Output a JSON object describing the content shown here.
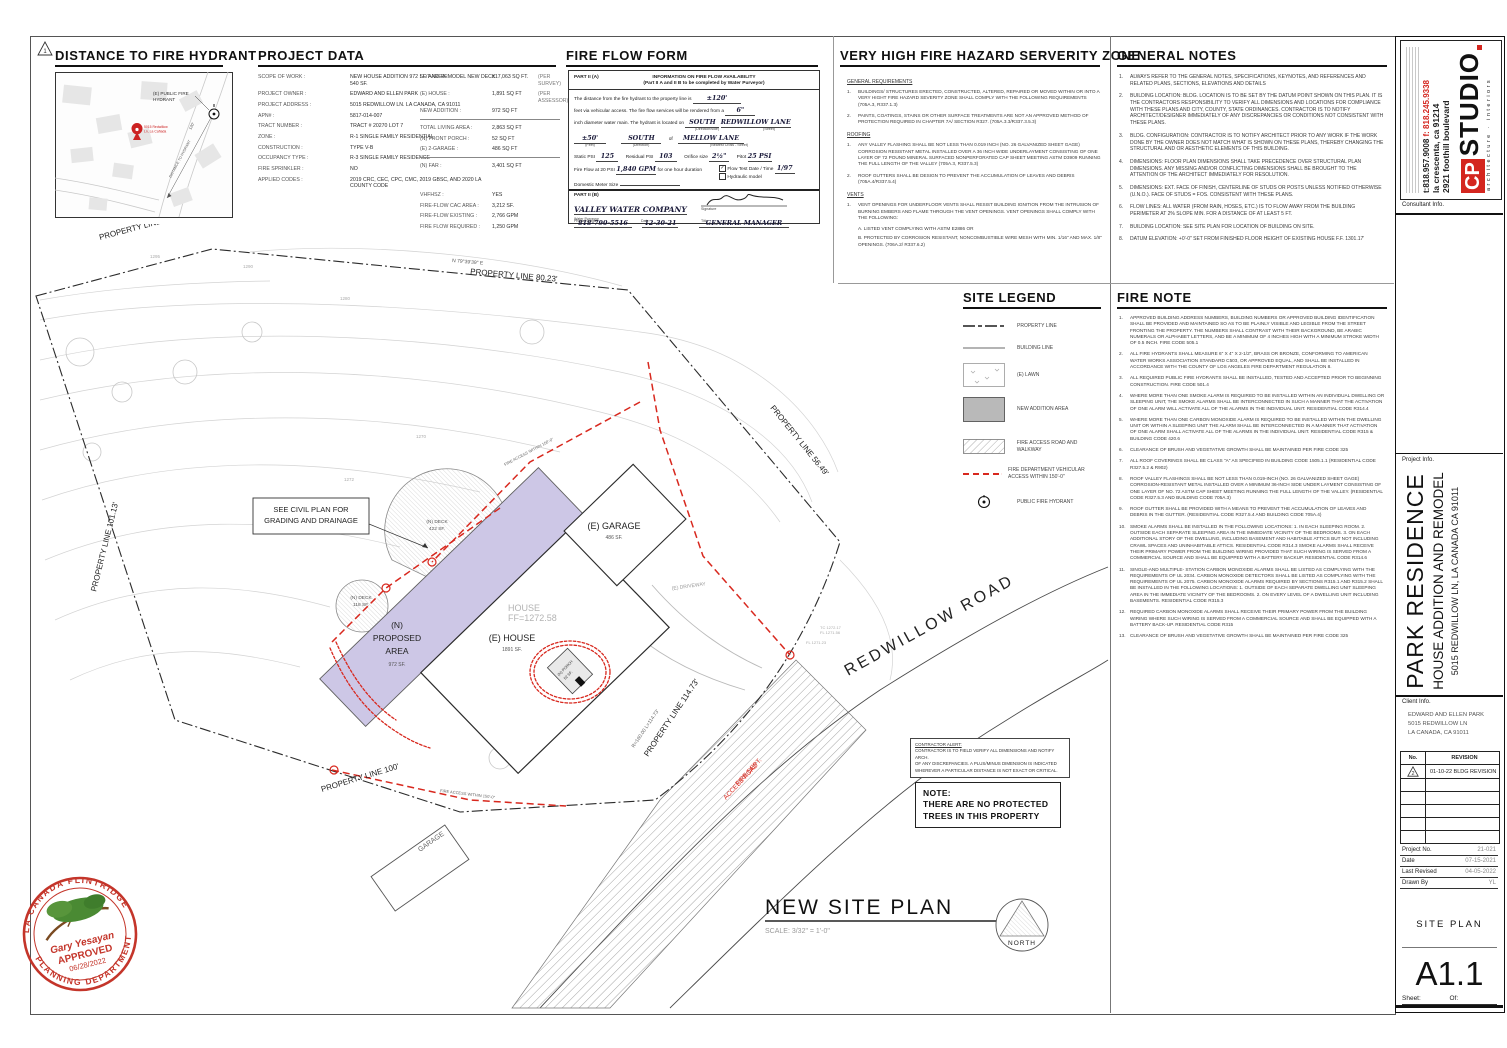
{
  "sheet": {
    "corner_marker": "1"
  },
  "hydrant_map": {
    "title": "DISTANCE TO FIRE HYDRANT",
    "hydrant_label_l1": "(E) PUBLIC FIRE",
    "hydrant_label_l2": "HYDRANT",
    "pin_label_l1": "5015 Redwillow",
    "pin_label_l2": "Ln, La Cañada",
    "distance_text": "DISTANCE TO HYDRANT",
    "distance_len": "120'"
  },
  "project_data": {
    "title": "PROJECT DATA",
    "left_rows": [
      {
        "label": "SCOPE OF WORK :",
        "value": "NEW HOUSE ADDITION 972 SF. AND REMODEL NEW DECK 540 SF."
      },
      {
        "label": "PROJECT OWNER :",
        "value": "EDWARD AND ELLEN PARK"
      },
      {
        "label": "PROJECT ADDRESS :",
        "value": "5015 REDWILLOW LN. LA CANADA, CA 91011"
      },
      {
        "label": "APN# :",
        "value": "5817-014-007"
      },
      {
        "label": "TRACT NUMBER :",
        "value": "TRACT # 20270 LOT 7"
      },
      {
        "label": "ZONE :",
        "value": "R-1 SINGLE FAMILY RESIDENTIAL"
      },
      {
        "label": "CONSTRUCTION :",
        "value": "TYPE V-B"
      },
      {
        "label": "OCCUPANCY TYPE :",
        "value": "R-3 SINGLE FAMILY RESIDENCE"
      },
      {
        "label": "FIRE SPRINKLER :",
        "value": "NO"
      },
      {
        "label": "APPLIED CODES :",
        "value": "2019 CRC, CEC, CPC, CMC, 2019 GBSC, AND 2020 LA COUNTY CODE"
      }
    ],
    "right_g1": [
      {
        "label": "LOT AREA :",
        "value": "±17,063 SQ FT.",
        "note": "(PER SURVEY)"
      },
      {
        "label": "(E) HOUSE :",
        "value": "1,891 SQ FT",
        "note": "(PER ASSESSOR)"
      },
      {
        "label": "NEW ADDITION :",
        "value": "972 SQ FT",
        "note": ""
      }
    ],
    "right_g2": [
      {
        "label": "TOTAL LIVING AREA :",
        "value": "2,863 SQ FT",
        "note": ""
      },
      {
        "label": "(N) FRONT PORCH :",
        "value": "52 SQ FT",
        "note": ""
      },
      {
        "label": "(E) 2-GARAGE :",
        "value": "486 SQ FT",
        "note": ""
      }
    ],
    "right_g3": [
      {
        "label": "(N) FAR :",
        "value": "3,401 SQ FT",
        "note": ""
      }
    ],
    "right_g4": [
      {
        "label": "VHFHSZ :",
        "value": "YES",
        "note": ""
      },
      {
        "label": "FIRE-FLOW CAC AREA :",
        "value": "3,212 SF.",
        "note": ""
      },
      {
        "label": "FIRE-FLOW  EXISTING :",
        "value": "2,766 GPM",
        "note": ""
      },
      {
        "label": "FIRE FLOW REQUIRED :",
        "value": "1,250 GPM",
        "note": ""
      }
    ]
  },
  "fire_flow_form": {
    "title": "FIRE FLOW FORM",
    "part_a_label": "PART II (A)",
    "part_a_heading": "INFORMATION ON FIRE FLOW AVAILABILITY",
    "part_a_subheading": "(Part II A and II B to be completed by Water Purveyor)",
    "line1_pre": "The distance from the fire hydrant to the property line is",
    "line1_value": "±120'",
    "line2_pre": "feet via vehicular access.  The fire flow services will be rendered from a",
    "line2_value": "6\"",
    "line3_pre": "inch diameter water main.  The hydrant is located on",
    "line3_value1": "SOUTH",
    "line3_cap1": "(Direction/side)",
    "line3_value2": "REDWILLOW LANE",
    "line3_cap2": "(Street)",
    "line4_value1": "±50'",
    "line4_cap1": "(Feet)",
    "line4_value2": "SOUTH",
    "line4_cap2": "(Direction)",
    "line4_of": "of",
    "line4_value3": "MELLOW LANE",
    "line4_cap3": "(Nearest Cross - Street)",
    "static_psi_label": "Static PSI",
    "static_psi": "125",
    "residual_psi_label": "Residual PSI",
    "residual_psi": "103",
    "orifice_label": "Orifice size",
    "orifice": "2½\"",
    "pitot_label": "Pitot",
    "pitot": "25 PSI",
    "fireflow_label": "Fire Flow at 20 PSI",
    "fireflow_value": "1,840 GPM",
    "fireflow_post": "for one hour duration",
    "flow_test_check": "✓",
    "flow_test_label": "Flow Test Date / Time",
    "flow_test_value": "1/97",
    "hydraulic_label": "Hydraulic model",
    "meter_label": "Domestic Meter Size",
    "part_b_label": "PART II (B)",
    "purveyor_value": "VALLEY WATER COMPANY",
    "purveyor_cap": "Water Purveyor",
    "signature_cap": "Signature",
    "phone_value": "818-790-5516",
    "phone_cap": "Phone Number",
    "date_value": "12-30-21",
    "date_cap": "Date",
    "title_value": "GENERAL MANAGER",
    "title_cap": "Title"
  },
  "vhfhsz": {
    "title": "VERY HIGH FIRE HAZARD SERVERITY ZONE",
    "general_heading": "GENERAL REQUIREMENTS",
    "general_items": [
      "BUILDINGS/ STRUCTURES ERECTED, CONSTRUCTED, ALTERED, REPAIRED OR MOVED WITHIN OR INTO A VERY HIGHT FIRE HAZARD SEVERITY ZONE SHALL COMPLY WITH THE FOLLOWING REQUIREMENTS (705A.3, R337.1.3)",
      "PAINTS, COATINGS, STAINS OR OTHER SURFACE TREATMENTS ARE NOT AN APPROVED METHOD OF PROTECTION REQUIRED IN CHAPTER 7A/ SECTION R327. (705A.3.3/R337.3.5.3)"
    ],
    "roofing_heading": "ROOFING",
    "roofing_items": [
      "ANY VALLEY FLASHING SHALL BE NOT LESS THAN 0.019 INCH (NO. 26 GALVANIZED SHEET GAGE) CORROSION RESISTANT METAL INSTALLED OVER A 36 INCH WIDE UNDERLAYMENT CONSISTING OF ONE LAYER OF 72 POUND MINERAL SURFACED NONPERFORATED CAP SHEET MEETING ASTM D3909 RUNNING THE FULL LENGTH OF THE VALLEY (705A.3, R337.5.3)",
      "ROOF GUTTERS SHALL BE DESIGN TO PREVENT THE ACCUMULATION OF LEAVES AND DEBRIS (705A.4/R337.5.4)"
    ],
    "vents_heading": "VENTS",
    "vents_items": [
      "VENT OPENINGS FOR UNDERFLOOR VENTS SHALL RESIST BUILDING IGNITION FROM THE INTRUSION OF BURNING EMBERS AND FLAME THROUGH THE VENT OPENINGS. VENT OPENINGS SHALL COMPLY WITH THE FOLLOWING:"
    ],
    "vents_extra": [
      "A. LISTED VENT COMPLYING WITH ASTM E2886 OR",
      "B. PROTECTED BY CORROSION RESISTANT, NONCOMBUSTIBLE WIRE MESH WITH MIN. 1/16\" AND MAX. 1/8\" OPENINGS. (706A.2/ R337.6.2)"
    ]
  },
  "general_notes": {
    "title": "GENERAL NOTES",
    "items": [
      "ALWAYS REFER TO THE GENERAL NOTES, SPECIFICATIONS, KEYNOTES, AND REFERENCES AND RELATED PLANS, SECTIONS, ELEVATIONS AND DETAILS",
      "BUILDING LOCATION: BLDG. LOCATION IS TO BE SET BY THE DATUM POINT SHOWN ON THIS PLAN. IT IS THE CONTRACTORS RESPONSIBILITY TO VERIFY ALL DIMENSIONS AND LOCATIONS FOR COMPLIANCE WITH THESE PLANS AND CITY, COUNTY, STATE ORDINANCES. CONTRACTOR IS TO NOTIFY ARCHITECT/DESIGNER IMMEDIATELY OF ANY DISCREPANCIES OR CONDITIONS NOT CONSISTENT WITH THESE PLANS.",
      "BLDG. CONFIGURATION: CONTRACTOR IS TO NOTIFY ARCHITECT PRIOR TO ANY WORK IF THE WORK DONE BY THE OWNER DOES NOT MATCH WHAT IS SHOWN ON THESE PLANS, THEREBY CHANGING THE STRUCTURAL AND OR AESTHETIC ELEMENTS OF THIS BUILDING.",
      "DIMENSIONS: FLOOR PLAN DIMENSIONS SHALL TAKE PRECEDENCE OVER STRUCTURAL PLAN DIMENSIONS. ANY MISSING AND/OR CONFLICTING DIMENSIONS SHALL BE BROUGHT TO THE ATTENTION OF THE ARCHITECT IMMEDIATELY FOR RESOLUTION.",
      "DIMENSIONS: EXT. FACE OF FINISH, CENTERLINE OF STUDS OR POSTS UNLESS NOTIFIED OTHERWISE (U.N.O.). FACE OF STUDS = FOS. CONSISTENT WITH THESE PLANS.",
      "FLOW LINES: ALL WATER (FROM RAIN, HOSES, ETC.) IS TO FLOW AWAY FROM THE BUILDING PERIMETER AT 2% SLOPE MIN. FOR A DISTANCE OF AT LEAST 5 FT.",
      "BUILDING LOCATION:  SEE SITE PLAN FOR LOCATION OF BUILDING ON SITE.",
      "DATUM ELEVATION: +0'-0\" SET FROM FINISHED FLOOR HEIGHT OF EXISTING HOUSE F.F. 1301.17'"
    ]
  },
  "site_legend": {
    "title": "SITE LEGEND",
    "items": [
      "PROPERTY LINE",
      "BUILDING LINE",
      "(E) LAWN",
      "NEW ADDITION AREA",
      "FIRE ACCESS ROAD AND WALKWAY",
      "FIRE DEPARTMENT VEHICULAR ACCESS WITHIN 150'-0\"",
      "PUBLIC FIRE HYDRANT"
    ]
  },
  "fire_note": {
    "title": "FIRE NOTE",
    "items": [
      "APPROVED BUILDING ADDRESS NUMBERS, BUILDING NUMBERS OR APPROVED BUILDING IDENTIFICATION SHALL BE PROVIDED AND MAINTAINED SO AS TO BE PLAINLY VISIBLE AND LEGIBLE FROM THE STREET FRONTING THE PROPERTY. THE NUMBERS SHALL CONTRAST WITH THEIR BACKGROUND, BE ARABIC NUMERALS OR ALPHABET LETTERS, AND BE A MINIMUM OF 4 INCHES HIGH WITH A MINIMUM STROKE WIDTH OF 0.5 INCH. FIRE CODE 505.1",
      "ALL FIRE HYDRANTS SHALL MEASURE 6\" X 4\" X 2-1/2\", BRASS OR BRONZE, CONFORMING TO AMERICAN WATER WORKS ASSOCIATION STANDARD C503, OR APPROVED EQUAL, AND SHALL BE INSTALLED IN ACCORDANCE WITH THE COUNTY OF LOS ANGELES FIRE DEPARTMENT REGULATION 8.",
      "ALL REQUIRED PUBLIC FIRE HYDRANTS SHALL BE INSTALLED, TESTED AND ACCEPTED PRIOR TO BEGINNING CONSTRUCTION. FIRE CODE 501.4",
      "WHERE MORE THAN ONE SMOKE ALARM IS REQUIRED TO BE INSTALLED WITHIN AN INDIVIDUAL DWELLING OR SLEEPING UNIT, THE SMOKE ALARMS SHALL BE INTERCONNECTED IN SUCH A MANNER THAT THE ACTIVATION OF ONE ALARM WILL ACTIVATE ALL OF THE ALARMS IN THE INDIVIDUAL UNIT. RESIDENTIAL CODE R314.4",
      "WHERE MORE THAN ONE CARBON MONOXIDE ALARM IS REQUIRED TO BE INSTALLED WITHIN THE DWELLING UNIT OR WITHIN A SLEEPING UNIT THE ALARM SHALL BE INTERCONNECTED IN A MANNER THAT ACTIVATION OF ONE ALARM SHALL ACTIVATE ALL OF THE ALARMS IN THE INDIVIDUAL UNIT. RESIDENTIAL CODE R315 & BUILDING CODE 420.6",
      "CLEARANCE OF BRUSH AND VEGETATIVE GROWTH SHALL BE MAINTAINED PER FIRE CODE 325",
      "ALL ROOF COVERINGS SHALL BE CLASS \"A\" AS SPECIFIED IN BUILDING CODE 1505.1.1 (RESIDENTIAL CODE R327.5.2 & R902)",
      "ROOF VALLEY FLASHINGS SHALL BE NOT LESS THAN 0.019-INCH (NO. 26 GALVANIZED SHEET GAGE) CORROSION-RESISTANT METAL INSTALLED OVER A MINIMUM 36-INCH SIDE UNDER LAYMENT CONSISTING OF ONE LAYER OF NO. 72 ASTM CAP SHEET MEETING RUNNING THE FULL LENGTH OF THE VALLEY. (RESIDENTIAL CODE R327.5.3 AND BUILDING CODE 705A.3)",
      "ROOF GUTTER SHALL BE PROVIDED WITH A MEANS TO PREVENT THE ACCUMULATION OF LEAVES AND DEBRIS IN THE GUTTER. (RESIDENTIAL CODE R327.5.4 AND BUILDING CODE 705A.4)",
      "SMOKE ALARMS SHALL BE INSTALLED IN THE FOLLOWING LOCATIONS: 1. IN EACH SLEEPING ROOM. 2. OUTSIDE EACH SEPARATE SLEEPING AREA IN THE IMMEDIATE VICINITY OF THE BEDROOMS. 3. ON EACH ADDITIONAL STORY OF THE DWELLING, INCLUDING BASEMENT AND HABITABLE ATTICS BUT NOT INCLUDING CRAWL SPACES AND UNINHABITABLE ATTICS. RESIDENTIAL CODE R314.3 SMOKE ALARMS SHALL RECEIVE THEIR PRIMARY POWER FROM THE BUILDING WIRING PROVIDED THAT SUCH WIRING IS SERVED FROM A COMMERCIAL SOURCE AND SHALL BE EQUIPPED WITH A BATTERY BACKUP. RESIDENTIAL CODE R314.6",
      "SINGLE-AND MULTIPLE- STATION CARBON MONOXIDE ALARMS SHALL BE LISTED AS COMPLYING WITH THE REQUIREMENTS OF UL 2034. CARBON MONOXIDE DETECTORS SHALL BE LISTED AS COMPLYING WITH THE REQUIREMENTS OF UL 2075. CARBON MONOXIDE ALARMS REQUIRED BY SECTIONS R315.1 AND R315.2 SHALL BE INSTALLED IN THE FOLLOWING LOCATIONS: 1. OUTSIDE OF EACH SEPARATE DWELLING UNIT SLEEPING AREA IN THE IMMEDIATE VICINITY OF THE BEDROOMS. 2. ON EVERY LEVEL OF A DWELLING UNIT INCLUDING BASEMENTS. RESIDENTIAL CODE R315.3",
      "REQUIRED CARBON MONOXIDE ALARMS SHALL RECEIVE THEIR PRIMARY POWER FROM THE BUILDING WIRING WHERE SUCH WIRING IS SERVED FROM A COMMERCIAL SOURCE AND SHALL BE EQUIPPED WITH A BATTERY BACK-UP. RESIDENTIAL CODE R315",
      "CLEARANCE OF BRUSH AND VEGETATIVE GROWTH SHALL BE MAINTAINED PER FIRE CODE 325"
    ]
  },
  "site_plan": {
    "title": "NEW SITE PLAN",
    "scale": "SCALE: 3/32\" = 1'-0\"",
    "north_label": "NORTH",
    "pl_6825": "PROPERTY LINE 68.25'",
    "bearing_top": "N 79°39'39\" E",
    "pl_8023": "PROPERTY LINE 80.23'",
    "pl_5649": "PROPERTY LINE 56.49'",
    "pl_10113": "PROPERTY LINE 101.13'",
    "pl_100": "PROPERTY LINE 100'",
    "pl_11473": "PROPERTY LINE 114.73'",
    "pl_radius": "R=160.00   L=114.73'",
    "road_label": "REDWILLOW  ROAD",
    "fire_road_l1": "FIRE DEPT.",
    "fire_road_l2": "ACCESS ROAD",
    "fire_access_150_a": "FIRE ACCESS WITHIN 150'-0\"",
    "fire_access_150_b": "FIRE ACCESS WITHIN 150'-0\"",
    "proposed_l1": "(N)",
    "proposed_l2": "PROPOSED",
    "proposed_l3": "AREA",
    "proposed_sf": "972 SF.",
    "house_label": "(E) HOUSE",
    "house_sf": "1891 SF.",
    "house_ff_1": "HOUSE",
    "house_ff_2": "FF=1272.58",
    "garage_label": "(E) GARAGE",
    "garage_sf": "486 SF.",
    "deck1_l1": "(N) DECK",
    "deck1_l2": "422 SF.",
    "deck2_l1": "(N) DECK",
    "deck2_l2": "118 SF.",
    "porch_l1": "(N) PORCH",
    "porch_l2": "52 SF.",
    "driveway_label": "(E) DRIVEWAY",
    "neighbor_garage": "GARAGE",
    "civil_note_l1": "SEE CIVIL PLAN FOR",
    "civil_note_l2": "GRADING AND DRAINAGE",
    "contour_1290": "1290",
    "contour_1295": "1295",
    "contour_1280": "1280",
    "contour_1272": "1272",
    "contour_1270": "1270",
    "spot_tc": "TC 1272.17",
    "spot_fl": "FL 1271.56",
    "spot_fl2": "FL 1271.23"
  },
  "contractor_alert": {
    "l1": "CONTRACTOR ALERT:",
    "l2": "CONTRACTOR IS TO FIELD VERIFY ALL DIMENSIONS AND NOTIFY ARCH.",
    "l3": "OF ANY DISCREPANCIES.  A PLUS/MINUS DIMENSION IS INDICATED",
    "l4": "WHEREVER A PARTICULAR DISTANCE IS NOT EXACT OR CRITICAL."
  },
  "note_box": {
    "l1": "NOTE:",
    "l2": "THERE ARE NO PROTECTED",
    "l3": "TREES IN THIS PROPERTY"
  },
  "stamp": {
    "arc_top": "LA CANADA FLINTRIDGE",
    "arc_bottom": "PLANNING DEPARTMENT",
    "name": "Gary Yesayan",
    "approved": "APPROVED",
    "date": "06/28/2022"
  },
  "title_block": {
    "logo_cp": "CP",
    "logo_studio": "STUDIO",
    "logo_sub": "architecture · interiors",
    "address_street": "2921 foothill boulevard",
    "address_city": "la crescenta, ca 91214",
    "phone": "t:818.957.9008",
    "fax": "f: 818.245.9338",
    "consultant_info_label": "Consultant Info.",
    "project_info_label": "Project Info.",
    "project_name": "PARK RESIDENCE",
    "project_desc": "HOUSE ADDITION AND REMODEL",
    "project_addr": "5015 REDWILLOW LN, LA CANADA CA 91011",
    "client_info_label": "Client Info.",
    "client_l1": "EDWARD AND ELLEN PARK",
    "client_l2": "5015 REDWILLOW LN",
    "client_l3": "LA CANADA, CA 91011",
    "rev_no_header": "No.",
    "rev_header": "REVISION",
    "rev1_no": "2",
    "rev1_text": "01-10-22 BLDG REVISION",
    "project_no_label": "Project No.",
    "project_no": "21-021",
    "date_label": "Date",
    "date": "07-15-2021",
    "revised_label": "Last Revised",
    "revised": "04-05-2022",
    "drawn_label": "Drawn By",
    "drawn": "YL",
    "sheet_title": "SITE PLAN",
    "sheet_no": "A1.1",
    "sheet_label": "Sheet:",
    "of_label": "Of:"
  }
}
